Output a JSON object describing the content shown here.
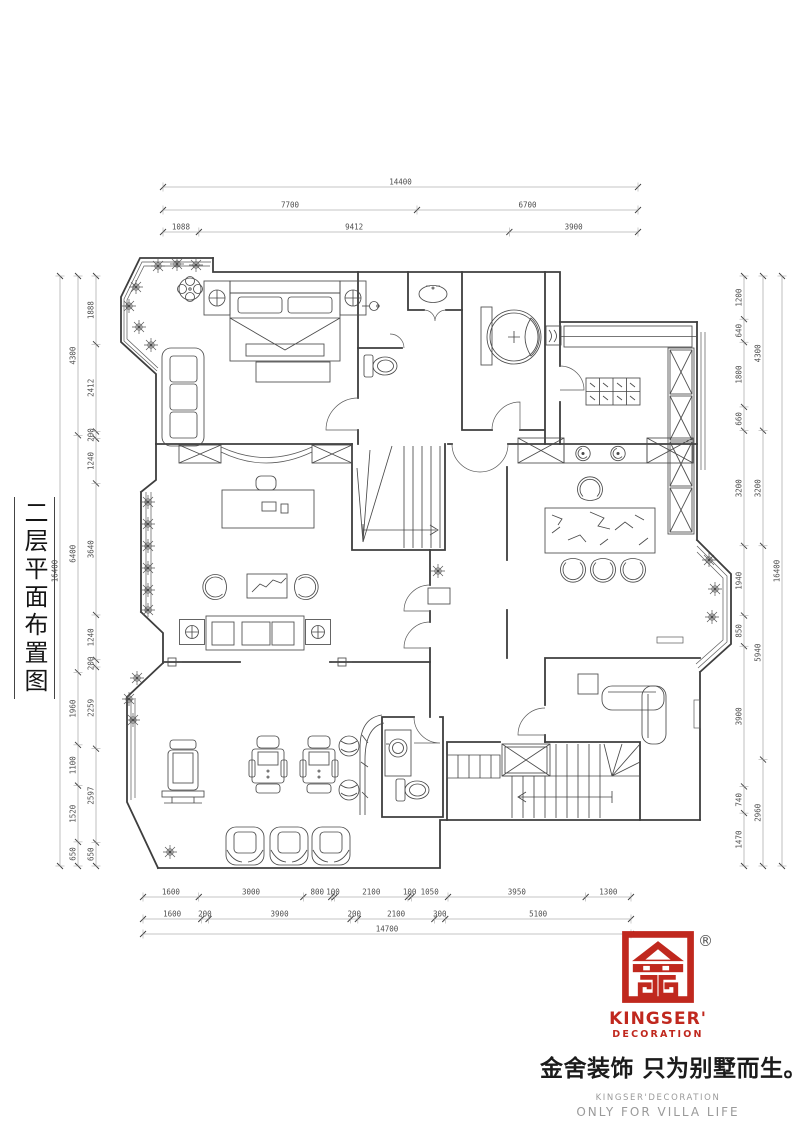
{
  "drawing_title": {
    "vertical_label": "二层平面布置图"
  },
  "dimensions": {
    "top": {
      "total": [
        "14400"
      ],
      "mid": [
        "7700",
        "6700"
      ],
      "inner": [
        "1088",
        "9412",
        "3900"
      ]
    },
    "bottom": {
      "inner": [
        "1600",
        "3000",
        "800",
        "100",
        "2100",
        "100",
        "1050",
        "3950",
        "1300"
      ],
      "mid": [
        "1600",
        "200",
        "3900",
        "200",
        "2100",
        "300",
        "5100"
      ],
      "total": [
        "14700"
      ]
    },
    "left": {
      "outer": [
        "16400"
      ],
      "mid": [
        "4300",
        "6400",
        "1960",
        "1100",
        "1520",
        "650"
      ],
      "inner": [
        "1888",
        "2412",
        "200",
        "1240",
        "3640",
        "1240",
        "200",
        "2259",
        "2597",
        "650"
      ]
    },
    "right": {
      "inner": [
        "1200",
        "640",
        "1800",
        "660",
        "3200",
        "1940",
        "850",
        "3900",
        "740",
        "1470"
      ],
      "mid": [
        "4300",
        "3200",
        "5940",
        "2960"
      ],
      "outer": [
        "16400"
      ]
    }
  },
  "logo": {
    "registered_mark": "®",
    "brand_line1": "KINGSER'",
    "brand_line2": "DECORATION",
    "headline_cn": "金舍装饰 只为别墅而生。",
    "sub_en": "KINGSER'DECORATION",
    "tagline_en": "ONLY FOR VILLA LIFE",
    "brand_red": "#c0281e",
    "text_gray": "#9a9a9a",
    "ink": "#1b1b1b"
  },
  "line_colors": {
    "walls": "#3e3e3e",
    "furniture": "#4a4a4a",
    "dims": "#6a6a6a"
  }
}
